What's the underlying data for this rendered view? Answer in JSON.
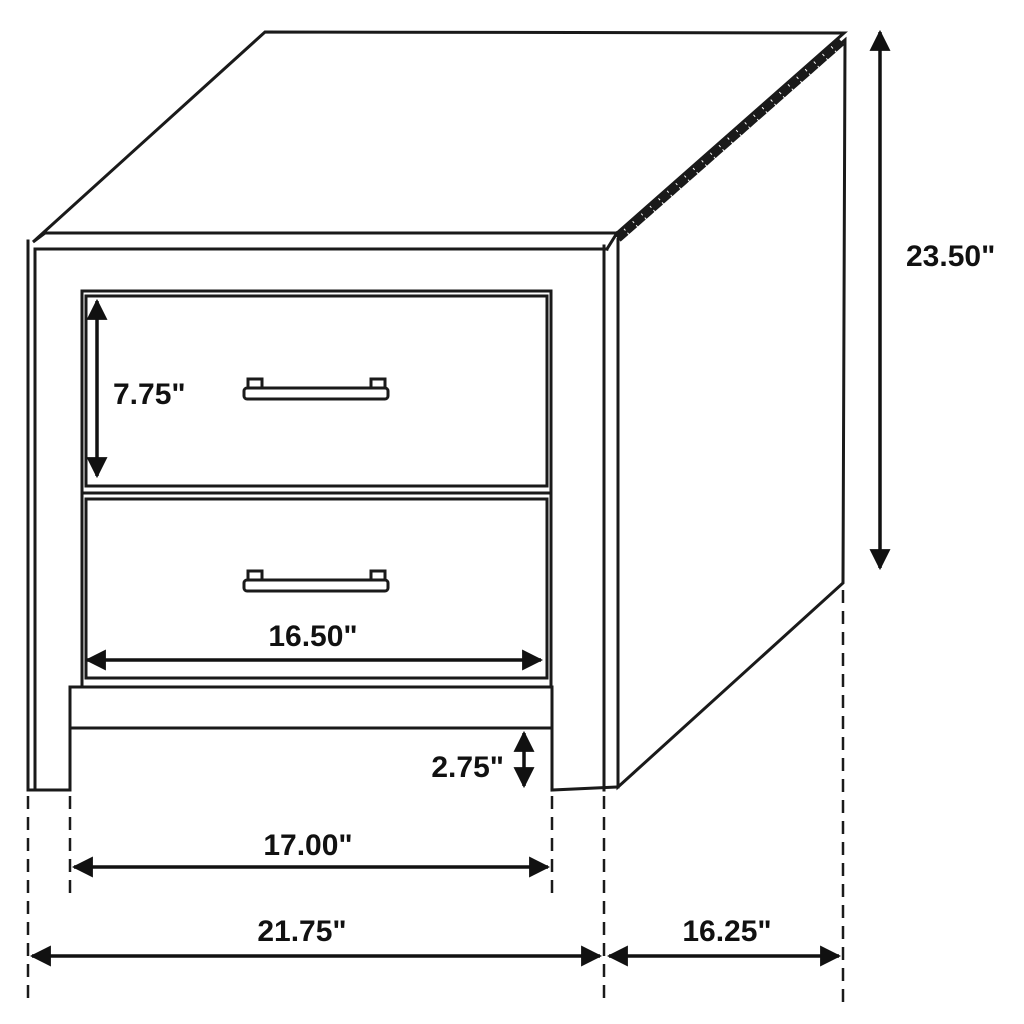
{
  "diagram": {
    "subject": "two-drawer nightstand dimension drawing",
    "unit": "inches",
    "dimensions": {
      "overall_height": {
        "label": "23.50\"",
        "value": 23.5
      },
      "top_drawer_height": {
        "label": "7.75\"",
        "value": 7.75
      },
      "drawer_width": {
        "label": "16.50\"",
        "value": 16.5
      },
      "leg_clearance": {
        "label": "2.75\"",
        "value": 2.75
      },
      "inner_leg_width": {
        "label": "17.00\"",
        "value": 17.0
      },
      "overall_width": {
        "label": "21.75\"",
        "value": 21.75
      },
      "depth": {
        "label": "16.25\"",
        "value": 16.25
      }
    }
  }
}
